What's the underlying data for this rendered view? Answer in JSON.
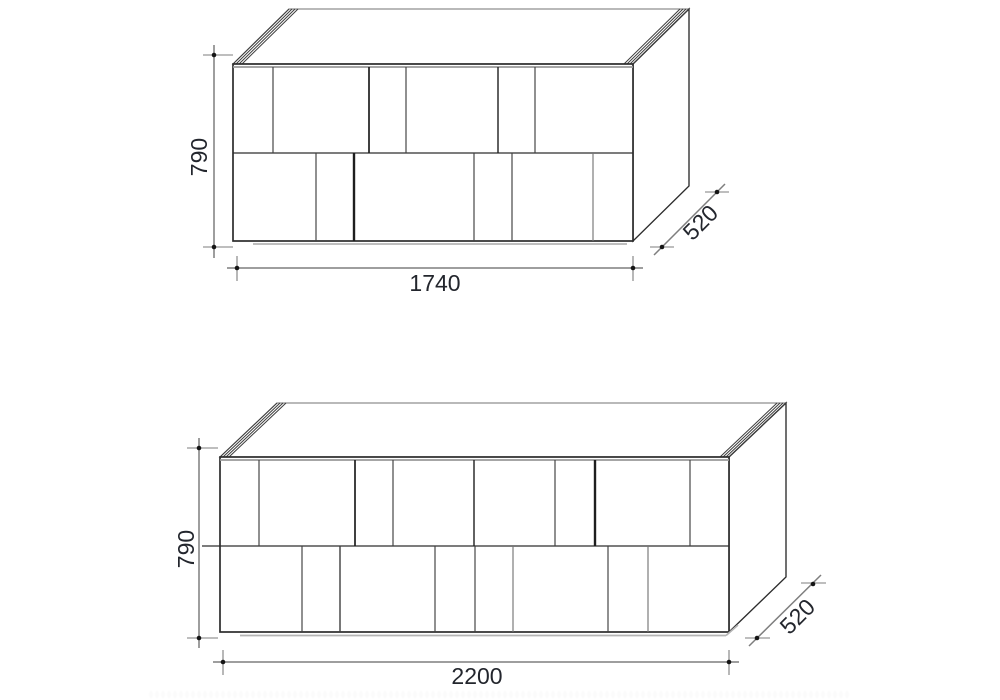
{
  "page": {
    "background": "#ffffff",
    "line_color": "#2c2c2c",
    "dimension_line_color": "#7e7e7e",
    "text_color": "#23262d",
    "description": "technical-dimension-drawings-of-two-sideboards"
  },
  "drawings": [
    {
      "name": "sideboard-1740",
      "height_mm": "790",
      "width_mm": "1740",
      "depth_mm": "520"
    },
    {
      "name": "sideboard-2200",
      "height_mm": "790",
      "width_mm": "2200",
      "depth_mm": "520"
    }
  ]
}
